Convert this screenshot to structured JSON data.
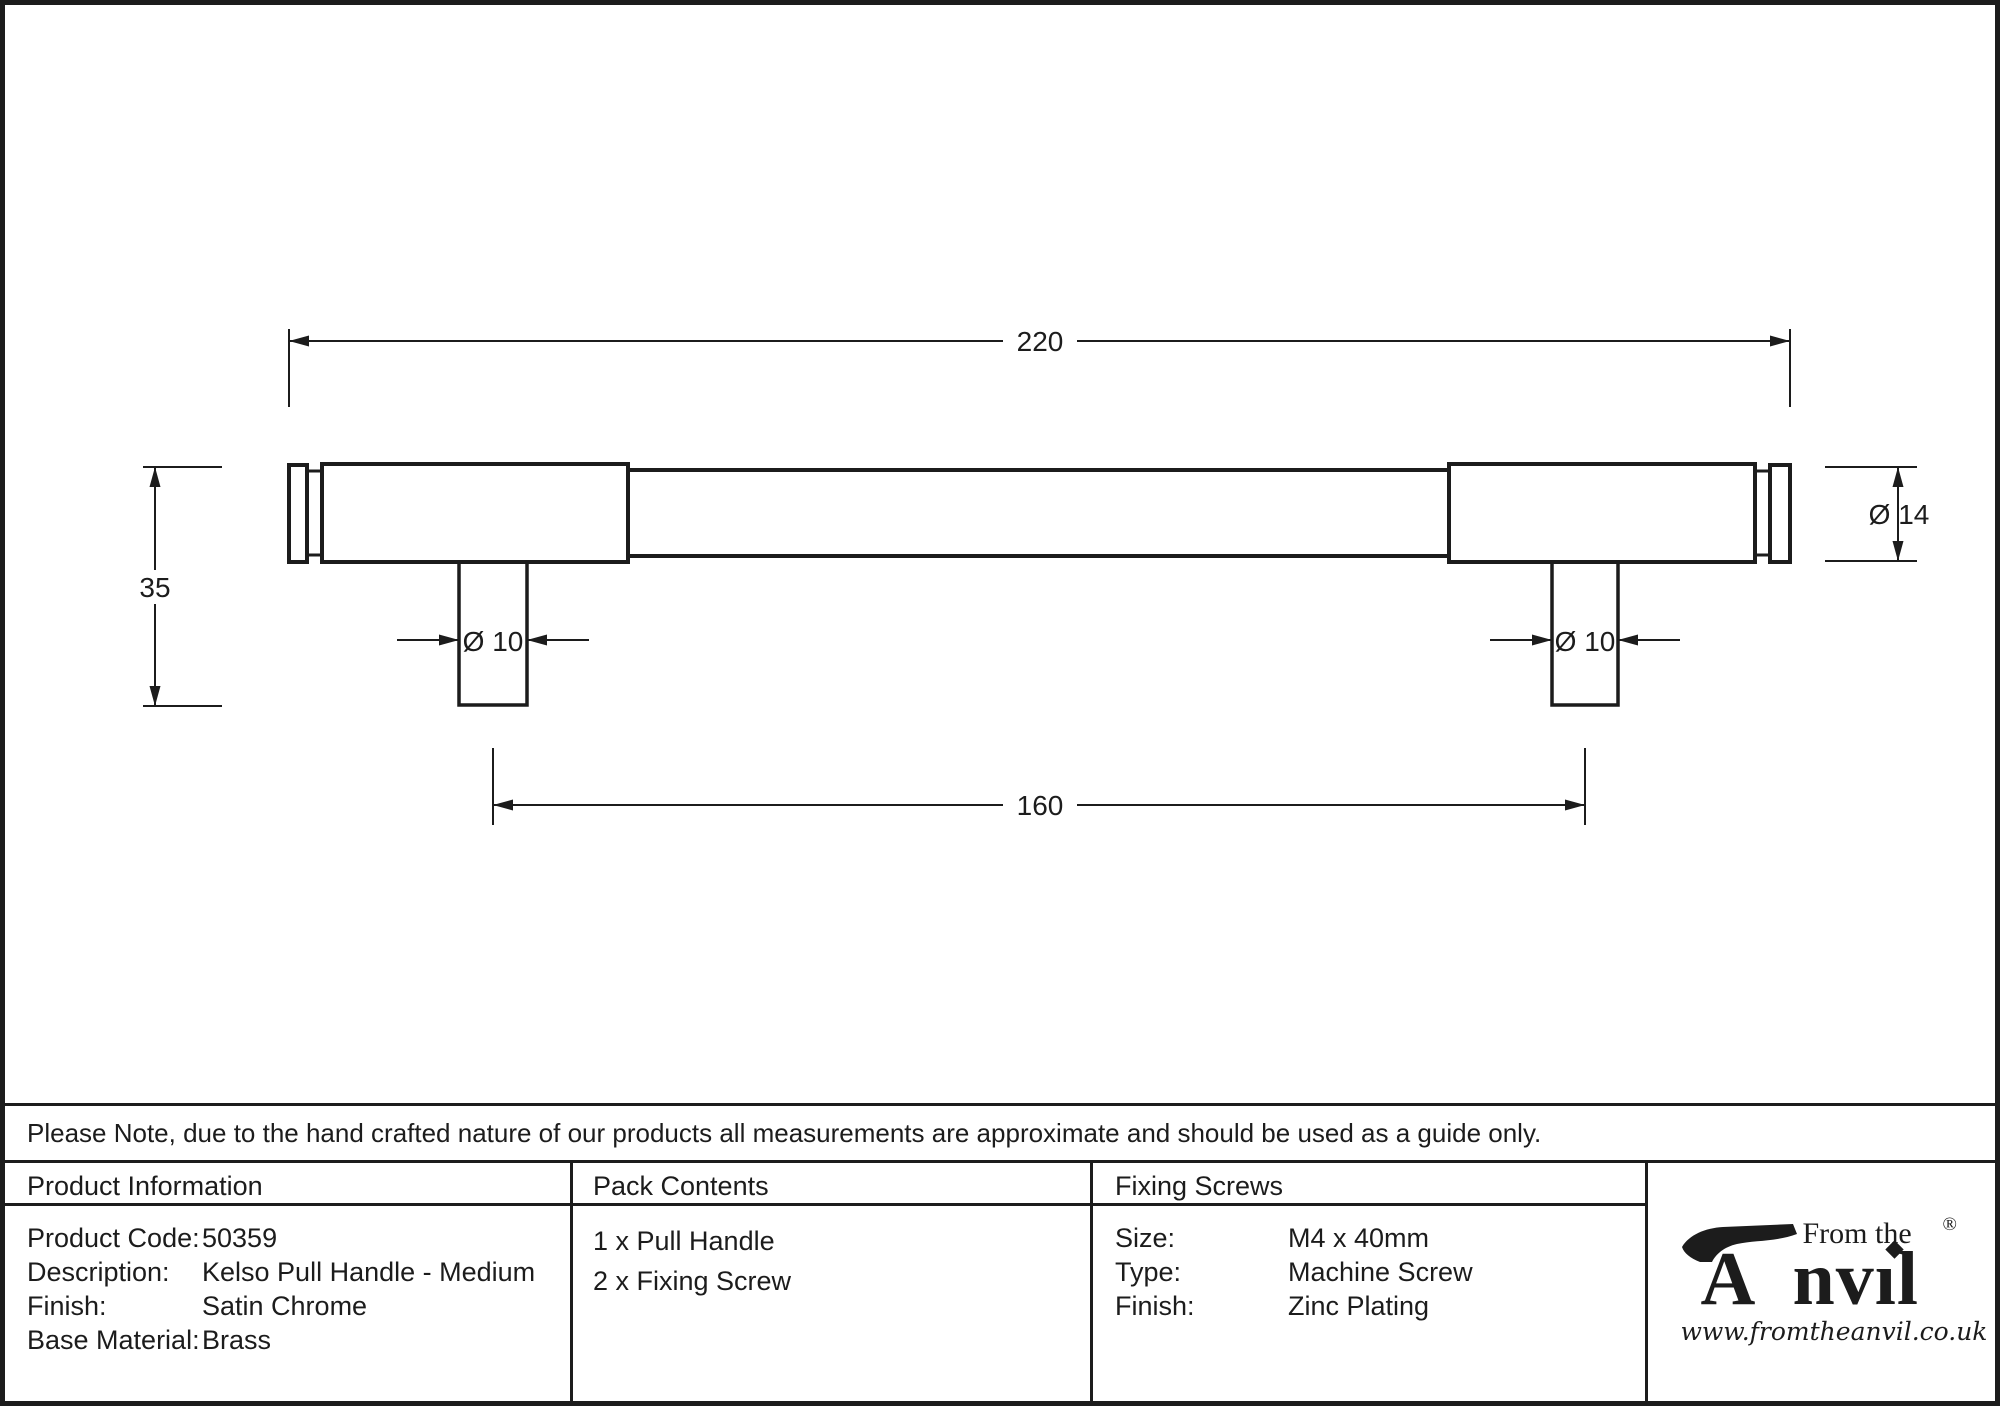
{
  "colors": {
    "ink": "#1c1c1c",
    "paper": "#ffffff"
  },
  "drawing": {
    "overall_length": "220",
    "projection": "35",
    "post_diameter": "Ø 10",
    "handle_diameter": "Ø 14",
    "fixing_centres": "160"
  },
  "note": {
    "text": "Please Note, due to the hand crafted nature of our products all measurements are approximate and should be used as a guide only."
  },
  "table": {
    "product_information": {
      "header": "Product Information",
      "rows": [
        {
          "label": "Product Code:",
          "value": "50359"
        },
        {
          "label": "Description:",
          "value": "Kelso Pull Handle - Medium"
        },
        {
          "label": "Finish:",
          "value": "Satin Chrome"
        },
        {
          "label": "Base Material:",
          "value": "Brass"
        }
      ]
    },
    "pack_contents": {
      "header": "Pack Contents",
      "items": [
        "1 x Pull Handle",
        "2 x Fixing Screw"
      ]
    },
    "fixing_screws": {
      "header": "Fixing Screws",
      "rows": [
        {
          "label": "Size:",
          "value": "M4 x 40mm"
        },
        {
          "label": "Type:",
          "value": "Machine Screw"
        },
        {
          "label": "Finish:",
          "value": "Zinc Plating"
        }
      ]
    },
    "logo": {
      "from_the": "From the",
      "letter_a": "A",
      "rest": "nvıl",
      "registered": "®",
      "website": "www.fromtheanvil.co.uk"
    }
  }
}
